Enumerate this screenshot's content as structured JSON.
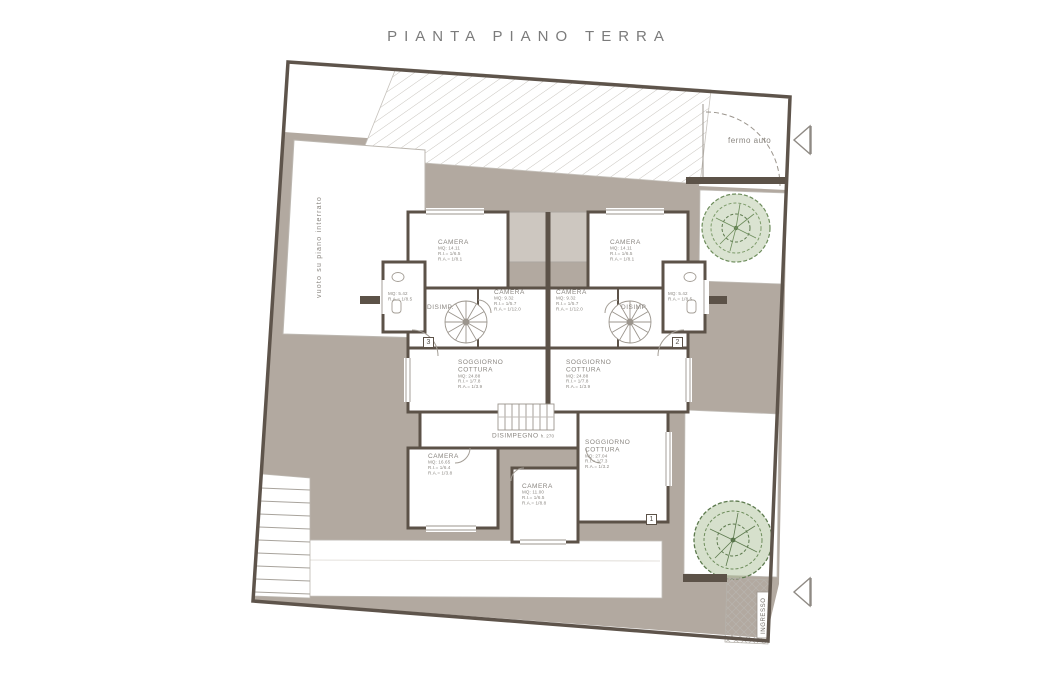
{
  "title": "PIANTA PIANO TERRA",
  "site": {
    "fermo_auto": "fermo auto",
    "vuoto_label": "vuoto su piano interrato",
    "ingresso_label": "INGRESSO"
  },
  "unit_markers": {
    "one": "1",
    "two": "2",
    "three": "3"
  },
  "rooms": {
    "camera_tl": {
      "name": "CAMERA",
      "mq": "MQ: 14.11",
      "ri": "R.I.= 1/6.5",
      "ra": "R.A.= 1/8.1"
    },
    "camera_tr": {
      "name": "CAMERA",
      "mq": "MQ: 14.11",
      "ri": "R.I.= 1/6.5",
      "ra": "R.A.= 1/8.1"
    },
    "camera_ml": {
      "name": "CAMERA",
      "mq": "MQ: 9.32",
      "ri": "R.I.= 1/5.7",
      "ra": "R.A.= 1/12.0"
    },
    "camera_mr": {
      "name": "CAMERA",
      "mq": "MQ: 9.32",
      "ri": "R.I.= 1/5.7",
      "ra": "R.A.= 1/12.0"
    },
    "disimp_l": {
      "name": "DISIMP."
    },
    "disimp_r": {
      "name": "DISIMP."
    },
    "bagno_l": {
      "mq": "MQ: 5.42",
      "ra": "R.A.= 1/8.5"
    },
    "bagno_r": {
      "mq": "MQ: 5.42",
      "ra": "R.A.= 1/8.5"
    },
    "soggiorno_l": {
      "name": "SOGGIORNO",
      "name2": "COTTURA",
      "mq": "MQ: 24.88",
      "ri": "R.I.= 1/7.8",
      "ra": "R.A.= 1/3.9"
    },
    "soggiorno_r": {
      "name": "SOGGIORNO",
      "name2": "COTTURA",
      "mq": "MQ: 24.88",
      "ri": "R.I.= 1/7.8",
      "ra": "R.A.= 1/3.9"
    },
    "disimpegno": {
      "name": "DISIMPEGNO",
      "h": "h. 270"
    },
    "camera_bl": {
      "name": "CAMERA",
      "mq": "MQ: 16.65",
      "ri": "R.I.= 1/6.4",
      "ra": "R.A.= 1/3.8"
    },
    "camera_bc": {
      "name": "CAMERA",
      "mq": "MQ: 11.00",
      "ri": "R.I.= 1/6.5",
      "ra": "R.A.= 1/8.8"
    },
    "soggiorno_b": {
      "name": "SOGGIORNO",
      "name2": "COTTURA",
      "mq": "MQ: 27.04",
      "ri": "R.I.= 1/7.3",
      "ra": "R.A.= 1/3.2"
    }
  },
  "colors": {
    "paving": "#b2a9a0",
    "wall": "#5c5248",
    "thin_line": "#9b958d",
    "tree_green": "#6e8d5c",
    "label_text": "#8a8680"
  }
}
